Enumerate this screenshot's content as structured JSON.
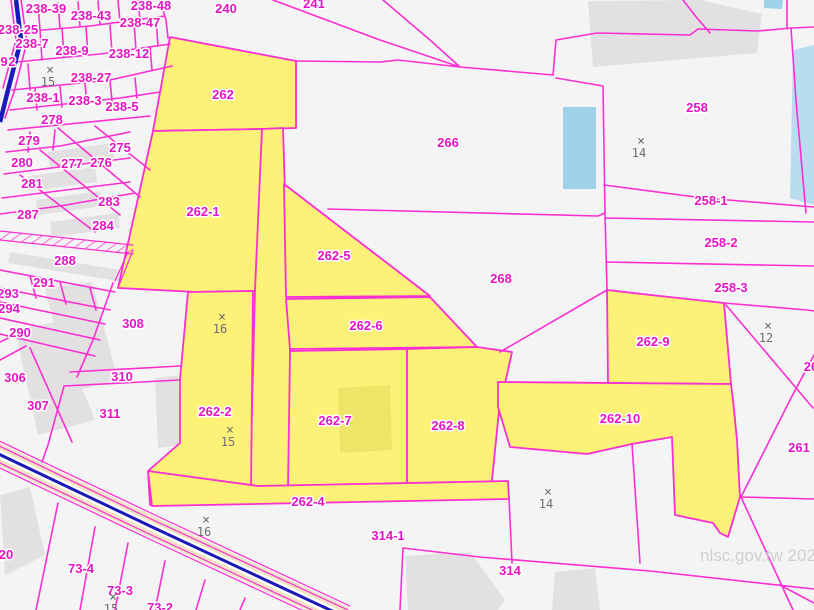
{
  "map": {
    "watermark": "nlsc.gov.tw 202",
    "colors": {
      "boundary": "#fb2fd2",
      "label": "#e514c4",
      "highlight": "#fdf178",
      "control": "#6e6e6e",
      "water": "#9fd2e8",
      "road_casing": "#f0e3c4",
      "road_center": "#1a1ab8",
      "building": "#e3e0e2",
      "bg": "#f5f4f5"
    },
    "highlighted_parcels": [
      "262",
      "262-1",
      "262-2",
      "262-4",
      "262-5",
      "262-6",
      "262-7",
      "262-8",
      "262-9",
      "262-10"
    ],
    "parcel_labels": [
      {
        "text": "238-39",
        "x": 46,
        "y": 13
      },
      {
        "text": "238-43",
        "x": 91,
        "y": 20
      },
      {
        "text": "238-48",
        "x": 151,
        "y": 10
      },
      {
        "text": "238-47",
        "x": 140,
        "y": 27
      },
      {
        "text": "238-25",
        "x": 18,
        "y": 34
      },
      {
        "text": "238-7",
        "x": 32,
        "y": 48
      },
      {
        "text": "238-9",
        "x": 72,
        "y": 55
      },
      {
        "text": "238-12",
        "x": 129,
        "y": 58
      },
      {
        "text": "238-27",
        "x": 91,
        "y": 82
      },
      {
        "text": "238-1",
        "x": 43,
        "y": 102
      },
      {
        "text": "238-3",
        "x": 85,
        "y": 105
      },
      {
        "text": "238-5",
        "x": 122,
        "y": 111
      },
      {
        "text": "278",
        "x": 52,
        "y": 124
      },
      {
        "text": "279",
        "x": 29,
        "y": 145
      },
      {
        "text": "280",
        "x": 22,
        "y": 167
      },
      {
        "text": "277",
        "x": 72,
        "y": 168
      },
      {
        "text": "276",
        "x": 101,
        "y": 167
      },
      {
        "text": "275",
        "x": 120,
        "y": 152
      },
      {
        "text": "281",
        "x": 32,
        "y": 188
      },
      {
        "text": "283",
        "x": 109,
        "y": 206
      },
      {
        "text": "287",
        "x": 28,
        "y": 219
      },
      {
        "text": "284",
        "x": 103,
        "y": 230
      },
      {
        "text": "288",
        "x": 65,
        "y": 265
      },
      {
        "text": "291",
        "x": 44,
        "y": 287
      },
      {
        "text": "293",
        "x": 8,
        "y": 298
      },
      {
        "text": "294",
        "x": 9,
        "y": 313
      },
      {
        "text": "290",
        "x": 20,
        "y": 337
      },
      {
        "text": "306",
        "x": 15,
        "y": 382
      },
      {
        "text": "308",
        "x": 133,
        "y": 328
      },
      {
        "text": "310",
        "x": 122,
        "y": 381
      },
      {
        "text": "307",
        "x": 38,
        "y": 410
      },
      {
        "text": "311",
        "x": 110,
        "y": 418
      },
      {
        "text": "240",
        "x": 226,
        "y": 13
      },
      {
        "text": "241",
        "x": 314,
        "y": 8
      },
      {
        "text": "262",
        "x": 223,
        "y": 99
      },
      {
        "text": "262-1",
        "x": 203,
        "y": 216
      },
      {
        "text": "262-5",
        "x": 334,
        "y": 260
      },
      {
        "text": "266",
        "x": 448,
        "y": 147
      },
      {
        "text": "268",
        "x": 501,
        "y": 283
      },
      {
        "text": "258",
        "x": 697,
        "y": 112
      },
      {
        "text": "258-1",
        "x": 711,
        "y": 205
      },
      {
        "text": "258-2",
        "x": 721,
        "y": 247
      },
      {
        "text": "258-3",
        "x": 731,
        "y": 292
      },
      {
        "text": "262-9",
        "x": 653,
        "y": 346
      },
      {
        "text": "262-6",
        "x": 366,
        "y": 330
      },
      {
        "text": "262-2",
        "x": 215,
        "y": 416
      },
      {
        "text": "262-7",
        "x": 335,
        "y": 425
      },
      {
        "text": "262-8",
        "x": 448,
        "y": 430
      },
      {
        "text": "262-10",
        "x": 620,
        "y": 423
      },
      {
        "text": "262-4",
        "x": 308,
        "y": 506
      },
      {
        "text": "261",
        "x": 799,
        "y": 452
      },
      {
        "text": "26",
        "x": 811,
        "y": 371
      },
      {
        "text": "314-1",
        "x": 388,
        "y": 540
      },
      {
        "text": "314",
        "x": 510,
        "y": 575
      },
      {
        "text": "73-4",
        "x": 81,
        "y": 573
      },
      {
        "text": "73-3",
        "x": 120,
        "y": 595
      },
      {
        "text": "73-2",
        "x": 160,
        "y": 612
      },
      {
        "text": "20",
        "x": 6,
        "y": 559
      },
      {
        "text": "9",
        "x": 4,
        "y": 66
      },
      {
        "text": "2",
        "x": 12,
        "y": 66
      }
    ],
    "control_points": [
      {
        "label": "15",
        "x": 50,
        "y": 74
      },
      {
        "label": "16",
        "x": 222,
        "y": 321
      },
      {
        "label": "15",
        "x": 230,
        "y": 434
      },
      {
        "label": "14",
        "x": 641,
        "y": 145
      },
      {
        "label": "12",
        "x": 768,
        "y": 330
      },
      {
        "label": "14",
        "x": 548,
        "y": 496
      },
      {
        "label": "16",
        "x": 206,
        "y": 524
      },
      {
        "label": "15",
        "x": 113,
        "y": 601
      }
    ]
  }
}
